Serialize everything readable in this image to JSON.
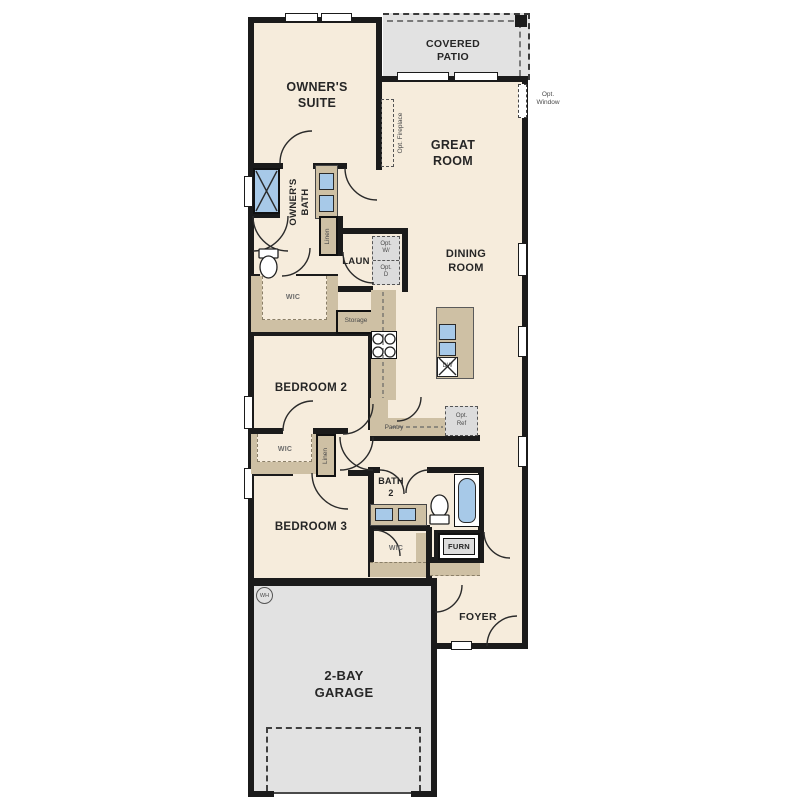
{
  "colors": {
    "floor": "#f6ecdc",
    "patio": "#e2e2e2",
    "cabinet": "#cec0a4",
    "fixture": "#a7c9e8",
    "wall": "#1b1b1b"
  },
  "labels": {
    "owners_suite": "OWNER'S\nSUITE",
    "covered_patio": "COVERED\nPATIO",
    "great_room": "GREAT\nROOM",
    "dining_room": "DINING\nROOM",
    "opt_window": "Opt.\nWindow",
    "opt_fireplace": "Opt. Fireplace",
    "owners_bath": "OWNER'S\nBATH",
    "linen_bath": "Linen",
    "linen_hall": "Linen",
    "laundry": "LAUN",
    "opt_washer": "Opt.\nW/",
    "opt_dryer": "Opt.\nD",
    "wic_owners": "WIC",
    "storage": "Storage",
    "dishwasher": "DW",
    "bedroom2": "BEDROOM 2",
    "pantry": "Pantry",
    "opt_ref": "Opt.\nRef",
    "wic_bed2": "WIC",
    "bedroom3": "BEDROOM 3",
    "bath2": "BATH\n2",
    "wic_bed3": "WIC",
    "furnace": "FURN",
    "foyer": "FOYER",
    "garage": "2-BAY\nGARAGE",
    "water_heater": "WH"
  }
}
